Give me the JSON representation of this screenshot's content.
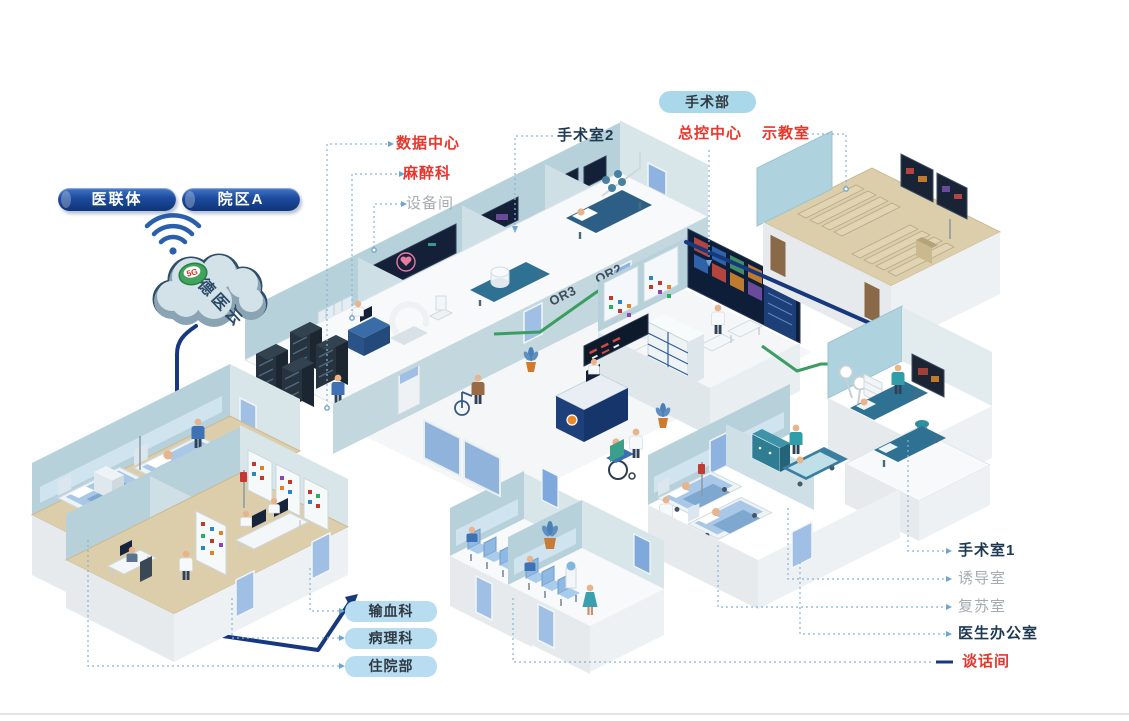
{
  "header_pills": {
    "alliance": "医联体",
    "campus": "院区A"
  },
  "cloud": {
    "name": "德医云",
    "badge": "5G"
  },
  "surgery_badge": "手术部",
  "callouts": {
    "data_center": "数据中心",
    "anesthesia": "麻醉科",
    "equipment_room": "设备间",
    "or2_label": "手术室2",
    "master_control": "总控中心",
    "demo_room": "示教室",
    "blood_transfusion": "输血科",
    "pathology": "病理科",
    "inpatient": "住院部",
    "or1_label": "手术室1",
    "induction_room": "诱导室",
    "recovery_room": "复苏室",
    "doctor_office": "医生办公室",
    "talk_room": "谈话间"
  },
  "room_signs": {
    "or2": "OR2",
    "or3": "OR3"
  },
  "colors": {
    "accent_red": "#e8362b",
    "label_dark": "#1e3a52",
    "label_gray": "#a6abb0",
    "pill_navy": "#0f3578",
    "pill_sky": "#a9d8ea",
    "pill_light": "#b9ddf0",
    "connection_navy": "#17387f",
    "green_pipe": "#3c9d63",
    "leader_blue": "#85b4d8",
    "wall_blue": "#b7d1da",
    "floor_tan": "#dcceaa"
  }
}
